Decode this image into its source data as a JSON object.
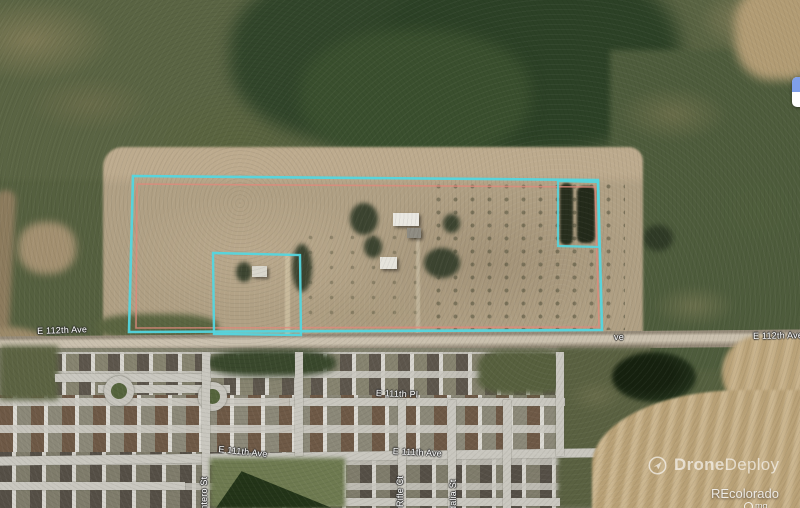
{
  "map_overlay": {
    "road_labels": [
      {
        "id": "e112th-ave-left",
        "text": "E 112th Ave",
        "x": 37,
        "y": 326,
        "rotate": -2
      },
      {
        "id": "e112th-ave-partial",
        "text": "ve",
        "x": 614,
        "y": 332,
        "rotate": 0
      },
      {
        "id": "e112th-ave-right",
        "text": "E 112th Ave",
        "x": 753,
        "y": 331,
        "rotate": -1
      },
      {
        "id": "e111th-pl",
        "text": "E 111th Pl",
        "x": 376,
        "y": 388,
        "rotate": 2
      },
      {
        "id": "e111th-ave-left",
        "text": "E 111th Ave",
        "x": 219,
        "y": 444,
        "rotate": 6
      },
      {
        "id": "e111th-ave-mid",
        "text": "E 111th Ave",
        "x": 393,
        "y": 446,
        "rotate": 3
      },
      {
        "id": "quintero-st-partial",
        "text": "intero St",
        "x": 199,
        "y": 512,
        "rotate": -90
      },
      {
        "id": "rifle-ct",
        "text": "Rifle Ct",
        "x": 395,
        "y": 507,
        "rotate": -90
      },
      {
        "id": "sedalia-st-partial",
        "text": "dalia St",
        "x": 448,
        "y": 511,
        "rotate": -90
      }
    ],
    "boundaries": {
      "accent_cyan": "#53d6df",
      "accent_red": "#e0897c",
      "polygons": [
        {
          "name": "survey-line",
          "color": "#e0897c",
          "width": 1.6,
          "opacity": 0.8,
          "points": [
            [
              137,
              184
            ],
            [
              595,
              187
            ],
            [
              599,
              327
            ],
            [
              136,
              328
            ]
          ]
        },
        {
          "name": "main-parcel-boundary",
          "color": "#53d6df",
          "width": 2.6,
          "opacity": 0.95,
          "points": [
            [
              133,
              176
            ],
            [
              598,
              180
            ],
            [
              602,
              330
            ],
            [
              129,
              332
            ]
          ]
        },
        {
          "name": "excluded-parcel-boundary",
          "color": "#53d6df",
          "width": 2.4,
          "opacity": 0.95,
          "points": [
            [
              213,
              253
            ],
            [
              300,
              255
            ],
            [
              301,
              335
            ],
            [
              214,
              334
            ]
          ]
        },
        {
          "name": "tree-parcel-boundary",
          "color": "#53d6df",
          "width": 2.2,
          "opacity": 0.9,
          "points": [
            [
              558,
              181
            ],
            [
              598,
              182
            ],
            [
              599,
              247
            ],
            [
              558,
              246
            ]
          ]
        }
      ]
    }
  },
  "watermarks": {
    "dronedeploy": {
      "brand_bold": "Drone",
      "brand_light": "Deploy"
    },
    "recolorado": "REcolorado",
    "attribution_partial": "mg"
  }
}
